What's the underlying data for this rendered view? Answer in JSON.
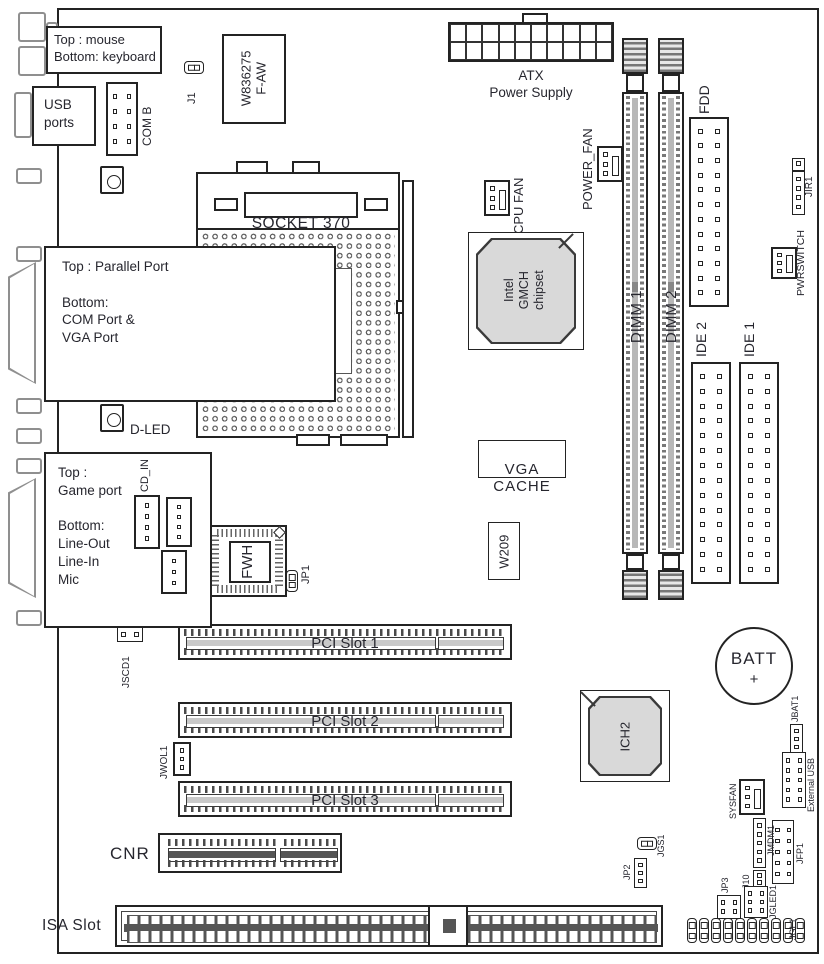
{
  "colors": {
    "chip_fill": "#d9d9d9",
    "line": "#232323",
    "text": "#26262e"
  },
  "back_panel": {
    "mouse_keyboard": "Top : mouse\nBottom: keyboard",
    "usb": "USB\nports",
    "parallel": "Top : Parallel Port\n\nBottom:\nCOM Port &\nVGA Port",
    "game": "Top :\nGame port\n\nBottom:\nLine-Out\nLine-In\nMic",
    "d_led": "D-LED"
  },
  "cpu": {
    "socket": "SOCKET 370"
  },
  "chips": {
    "super_io": "W836275\nF-AW",
    "gmch": "Intel\nGMCH\nchipset",
    "fwh": "FWH",
    "vga_cache": "VGA\nCACHE",
    "w209": "W209",
    "ich2": "ICH2"
  },
  "power": {
    "atx": "ATX\nPower Supply",
    "cpu_fan": "CPU FAN",
    "power_fan": "POWER_FAN",
    "sysfan": "SYSFAN",
    "pwrswitch": "PWRSWITCH",
    "battery": "BATT",
    "battery_plus": "+"
  },
  "memory": {
    "dimm1": "DIMM 1",
    "dimm2": "DIMM 2"
  },
  "storage": {
    "fdd": "FDD",
    "ide1": "IDE 1",
    "ide2": "IDE 2"
  },
  "slots": {
    "pci1": "PCI Slot 1",
    "pci2": "PCI Slot 2",
    "pci3": "PCI Slot 3",
    "cnr": "CNR",
    "isa": "ISA Slot"
  },
  "headers": {
    "com_b": "COM B",
    "j1": "J1",
    "jir1": "JIR1",
    "cd_in": "CD_IN",
    "aux_in": "AUX_IN",
    "modem_in": "MODEM_IN",
    "jp1": "JP1",
    "jscd1": "JSCD1",
    "jwol1": "JWOL1",
    "jbat1": "JBAT1",
    "external_usb": "External USB",
    "jfp1": "JFP1",
    "jmdm1": "JMDM1",
    "j10": "J10",
    "jgled1": "JGLED1",
    "jgl1": "JGL1",
    "jp3": "JP3",
    "jp2": "JP2",
    "jgs1": "JGS1"
  }
}
